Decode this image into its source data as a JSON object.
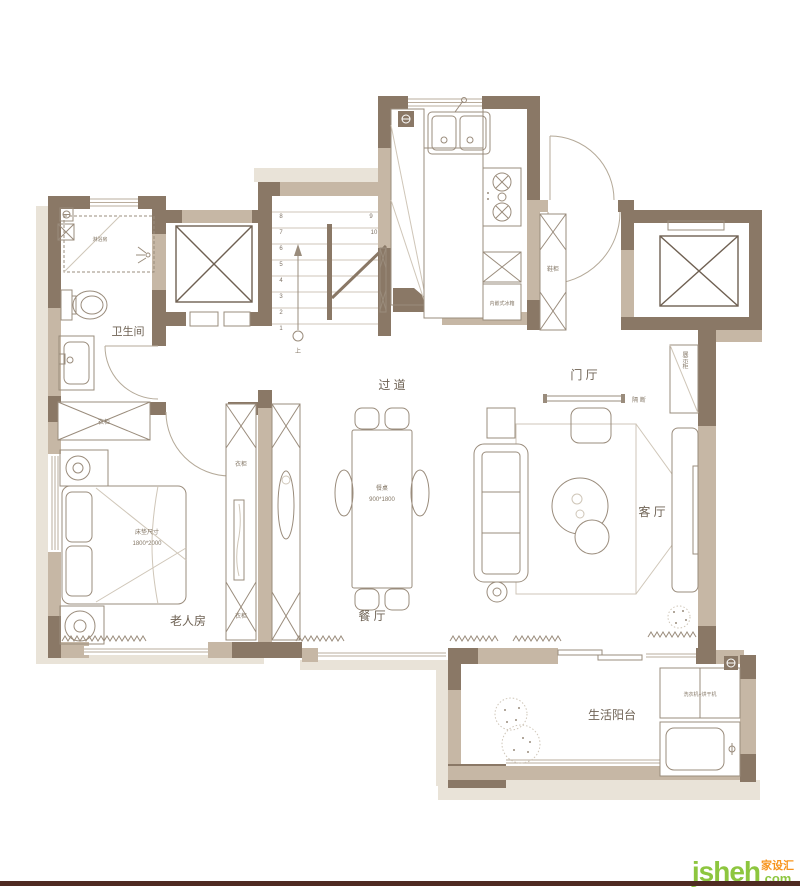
{
  "plan": {
    "rooms": {
      "bathroom": "卫生间",
      "corridor": "过 道",
      "foyer": "门 厅",
      "living": "客 厅",
      "dining": "餐 厅",
      "bedroom": "老人房",
      "balcony": "生活阳台"
    },
    "labels": {
      "shower": "淋浴房",
      "fridge": "内嵌式冰箱",
      "shoe_cabinet": "鞋柜",
      "partition": "隔 断",
      "display_cabinet": "展示柜",
      "wardrobe_top": "衣柜",
      "wardrobe_right": "衣柜",
      "wardrobe_bottom": "衣柜",
      "mattress_title": "床垫尺寸",
      "mattress_size": "1800*2000",
      "table_title": "餐桌",
      "table_size": "900*1800",
      "washer_dryer": "洗衣机+烘干机",
      "stairs_up": "上"
    },
    "stairs": {
      "numbers": [
        "1",
        "2",
        "3",
        "4",
        "5",
        "6",
        "7",
        "8",
        "9",
        "10"
      ]
    }
  },
  "footer": {
    "logo_main": "jsheh",
    "logo_tld": ".com",
    "logo_brand": "家设汇"
  },
  "colors": {
    "wall_dark": "#8a7866",
    "wall_mid": "#c6b7a5",
    "shadow": "#e9e3d8",
    "furniture_line": "#9a8c7c",
    "label_text": "#6f6355",
    "logo_green": "#8dc63f",
    "logo_orange": "#f7941d",
    "footer_bar": "#4f2b22"
  }
}
